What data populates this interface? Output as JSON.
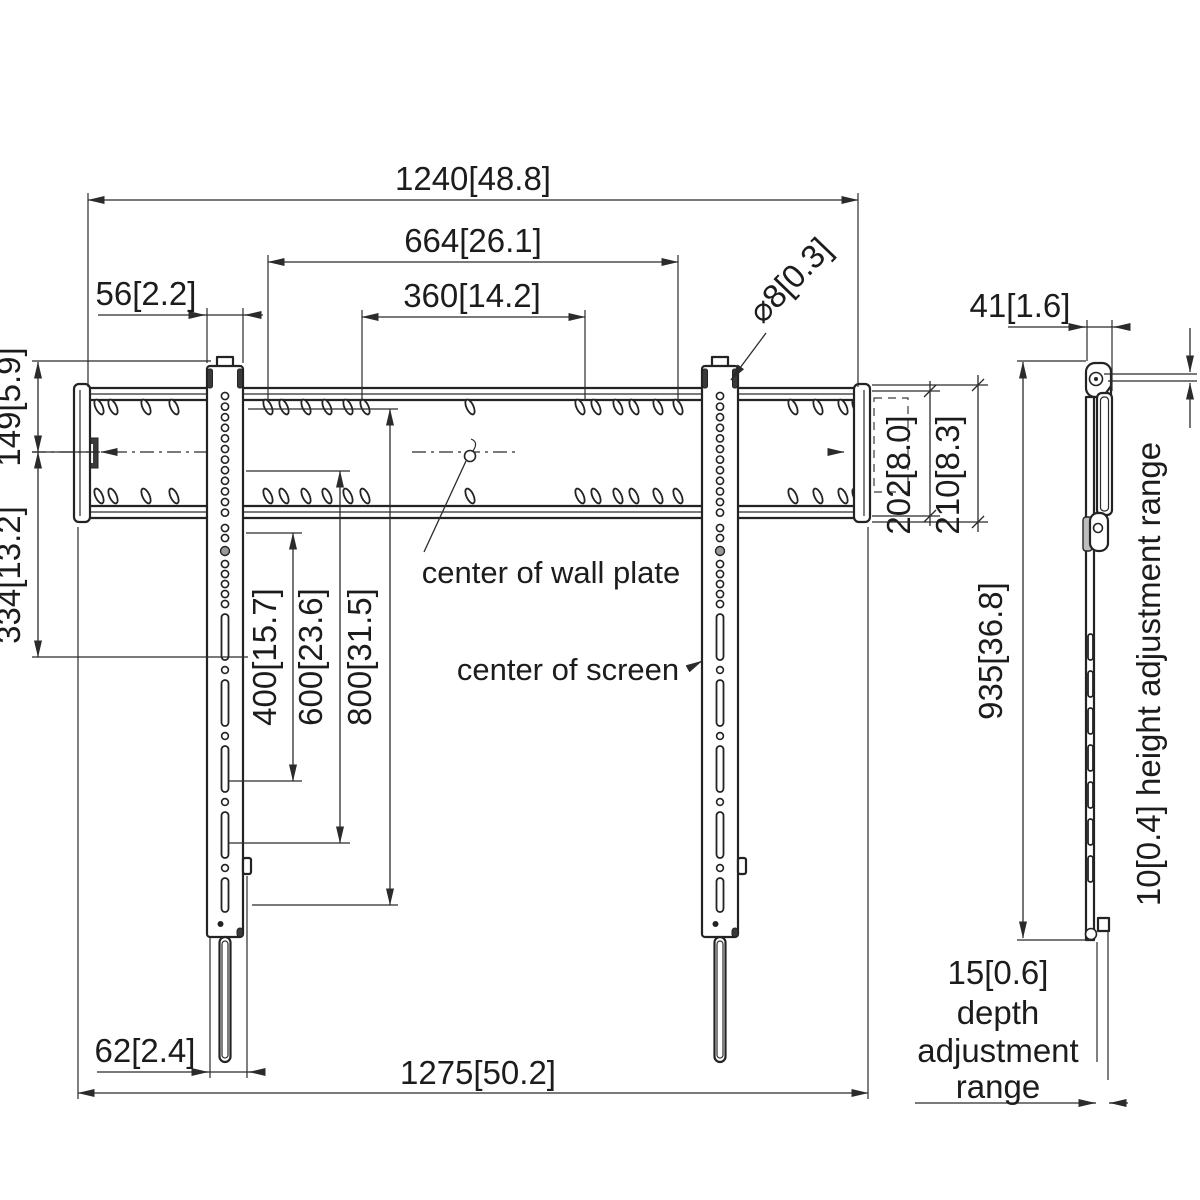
{
  "front": {
    "dims": {
      "overall_width": "1240[48.8]",
      "hole_span": "664[26.1]",
      "vesa_width": "360[14.2]",
      "rail_width": "56[2.2]",
      "hole_diameter": "⌀8[0.3]",
      "rail_top_to_center": "149[5.9]",
      "center_to_lower_hole": "334[13.2]",
      "vesa_400": "400[15.7]",
      "vesa_600": "600[23.6]",
      "vesa_800": "800[31.5]",
      "plate_height": "202[8.0]",
      "plate_height_outer": "210[8.3]",
      "strap_offset": "62[2.4]",
      "overall_width_bottom": "1275[50.2]"
    },
    "labels": {
      "center_of_wall_plate": "center of wall plate",
      "center_of_screen": "center of screen"
    }
  },
  "side": {
    "dims": {
      "depth": "41[1.6]",
      "height": "935[36.8]"
    },
    "labels": {
      "height_adjustment": "10[0.4] height adjustment range",
      "depth_adjustment_value": "15[0.6]",
      "depth_adjustment_line2": "depth",
      "depth_adjustment_line3": "adjustment",
      "depth_adjustment_line4": "range"
    }
  },
  "colors": {
    "line": "#232323",
    "background": "#ffffff"
  }
}
